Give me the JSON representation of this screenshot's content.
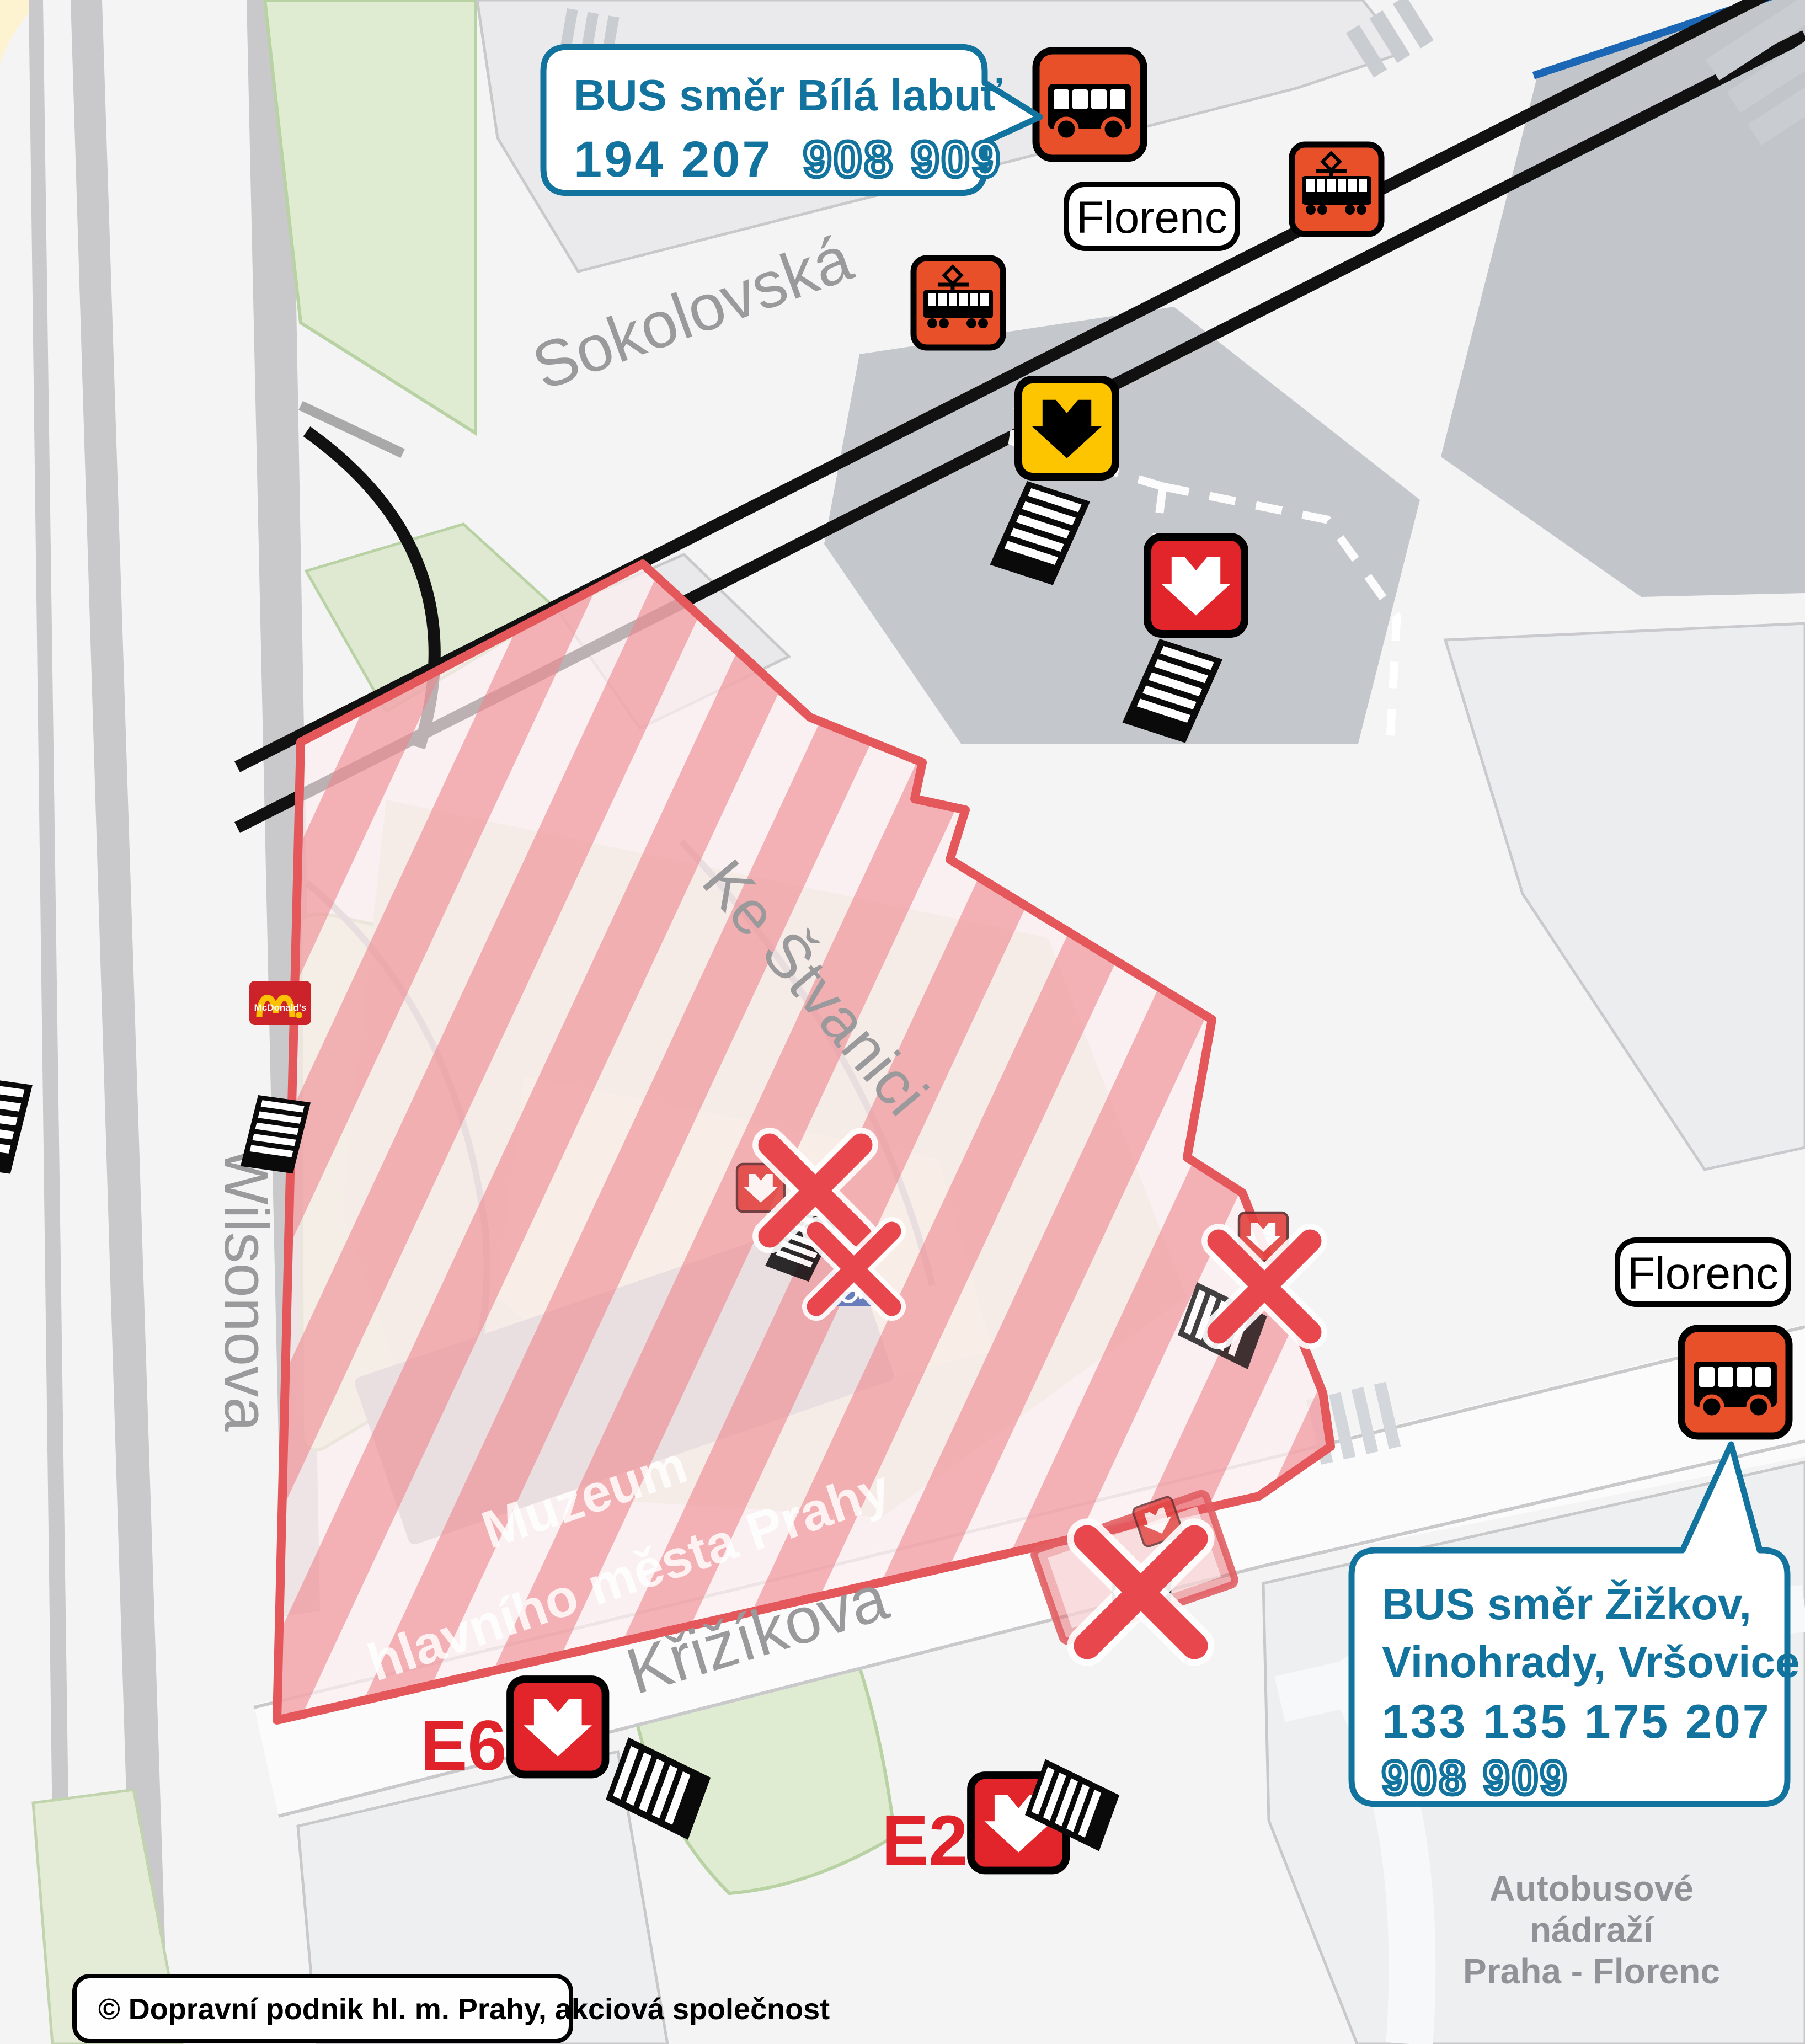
{
  "map": {
    "street_labels": {
      "sokolovska": "Sokolovská",
      "wilsonova": "Wilsonova",
      "ke_stvanici": "Ke Štvanici",
      "krizikova": "Křižíkova"
    },
    "poi_labels": {
      "muzeum_line1": "Muzeum",
      "muzeum_line2": "hlavního města Prahy",
      "bus_terminal_line1": "Autobusové",
      "bus_terminal_line2": "nádraží",
      "bus_terminal_line3": "Praha - Florenc",
      "mcdonalds": "McDonald's"
    },
    "station_labels": {
      "florenc_top": "Florenc",
      "florenc_right": "Florenc"
    },
    "entrance_labels": {
      "e6": "E6",
      "e2": "E2"
    },
    "copyright": "© Dopravní podnik hl. m. Prahy, akciová společnost"
  },
  "callouts": {
    "bila_labut": {
      "title": "BUS směr Bílá labuť",
      "day_lines": "194  207",
      "night_lines": "908  909"
    },
    "zizkov": {
      "title_line1": "BUS směr Žižkov,",
      "title_line2": "Vinohrady, Vršovice",
      "day_lines": "133  135  175  207",
      "night_lines": "908  909"
    }
  },
  "colors": {
    "callout_blue": "#11739e",
    "bus_tram_orange": "#e8502a",
    "metro_red": "#e2242b",
    "metro_yellow": "#fdc500",
    "closure_red": "#e4575a",
    "park_green": "#e0ecd2",
    "building_gray": "#c4c8cd"
  }
}
